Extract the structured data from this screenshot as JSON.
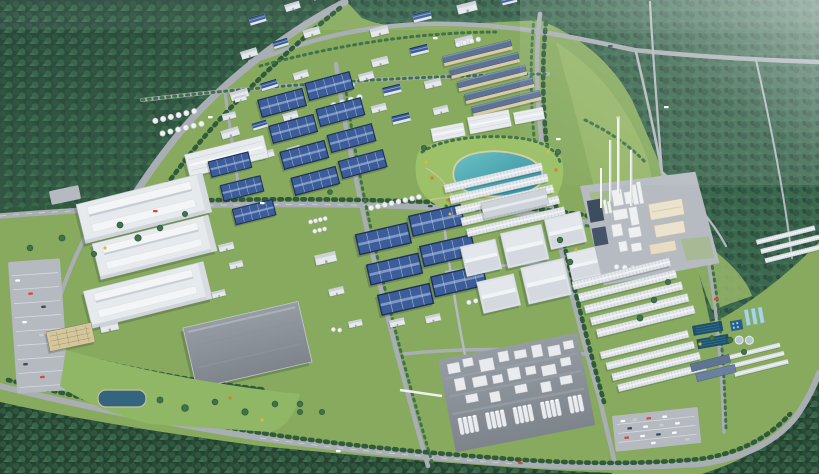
{
  "scene": {
    "kind": "aerial-3d-architectural-rendering",
    "subject": "industrial-park-masterplan",
    "features": [
      "dense-forest-belt",
      "perimeter-road",
      "tree-lined-avenues",
      "blue-roof-factory-blocks",
      "white-warehouse-halls",
      "giant-logistics-halls",
      "storage-tank-farms",
      "central-lake-park",
      "cement-plant-with-chimneys",
      "process-plant-with-silo-rows",
      "water-treatment-basins",
      "parking-lots-with-cars",
      "gray-flat-warehouse",
      "lawn-with-pond",
      "haze-top-right"
    ]
  },
  "palette": {
    "grass": "#87aa5f",
    "grass2": "#97b769",
    "parkGreen": "#9cc168",
    "lawn": "#8fb766",
    "forestDark": "#2b4f3d",
    "forestMid": "#3c6851",
    "forestDeep": "#24432f",
    "treeDark": "#2f5a3b",
    "treeMid": "#41724a",
    "road": "#a9aeb4",
    "roadLight": "#b5bac0",
    "roofNavy": "#1d3158",
    "roofBlue": "#3c5d99",
    "roofBlueLight": "#7e9ac8",
    "roofWhite": "#e8ebee",
    "cream": "#ebe3cd",
    "tanWall": "#d9cba6",
    "padGray": "#8f959c",
    "lake1": "#63bcc2",
    "lake2": "#2f8a9a",
    "pond": "#33667e",
    "basin": "#1e4f6b",
    "paleBasin": "#a6d6e6",
    "sand": "#d7cfa4",
    "haze": "#f2f7f8"
  }
}
